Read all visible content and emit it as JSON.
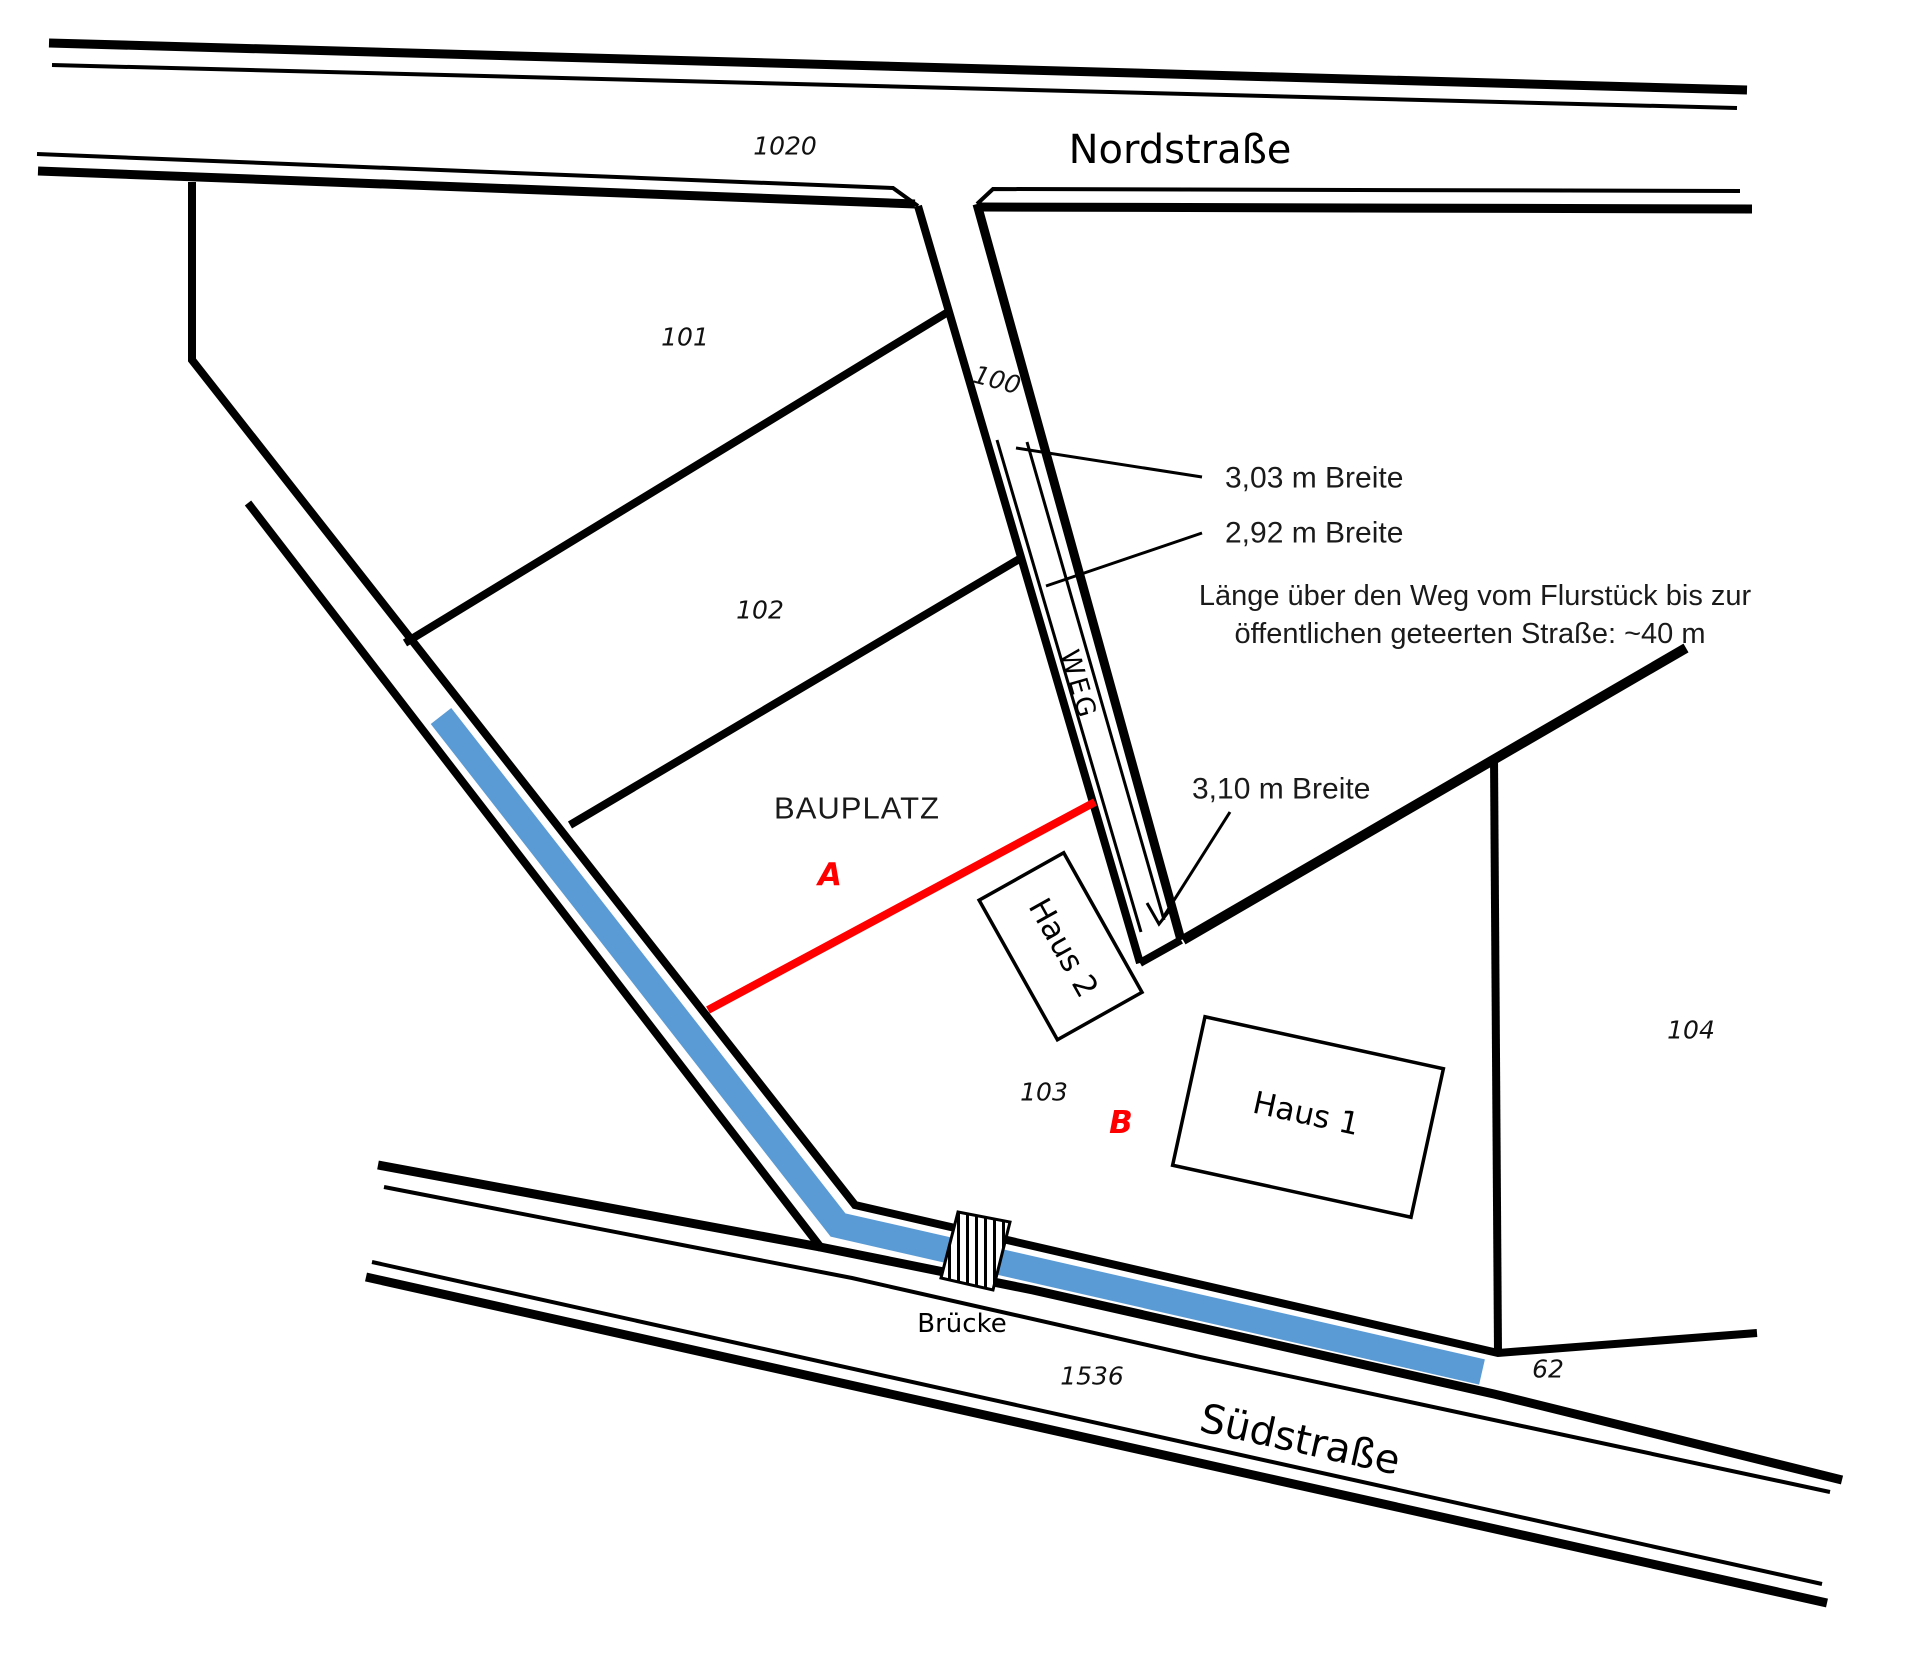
{
  "colors": {
    "waterway_blue": "#5B9BD5",
    "proposal_red": "#FF0000",
    "drawing_black": "#000000",
    "paper_white": "#FFFFFF"
  },
  "streets": {
    "north": {
      "name": "Nordstraße",
      "parcel_number": "1020"
    },
    "south": {
      "name": "Südstraße",
      "parcel_number": "1536"
    }
  },
  "path": {
    "name": "WEG",
    "parcel_number": "100"
  },
  "bridge": {
    "label": "Brücke"
  },
  "parcels": {
    "p101": "101",
    "p102": "102",
    "p103": "103",
    "p104": "104",
    "p62": "62"
  },
  "buildings": {
    "haus1": "Haus 1",
    "haus2": "Haus 2"
  },
  "building_site": {
    "title": "BAUPLATZ",
    "area_a": "A",
    "area_b": "B"
  },
  "annotations": {
    "width_north": "3,03 m Breite",
    "width_middle": "2,92 m Breite",
    "width_south": "3,10 m Breite",
    "length_note_line1": "Länge über den Weg vom Flurstück bis zur",
    "length_note_line2": "öffentlichen geteerten Straße: ~40 m"
  }
}
